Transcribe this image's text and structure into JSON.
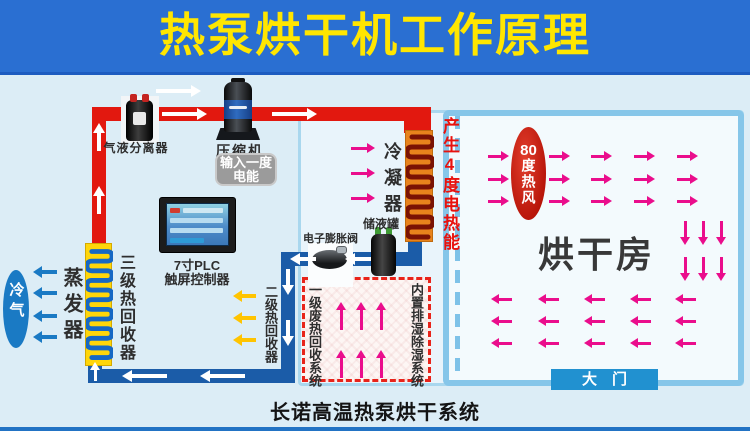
{
  "title": "热泵烘干机工作原理",
  "caption": "长诺高温热泵烘干系统",
  "labels": {
    "separator": "气液分离器",
    "compressor": "压缩机",
    "power_input": "输入一度电能",
    "plc_line1": "7寸PLC",
    "plc_line2": "触屏控制器",
    "condenser": "冷凝器",
    "heat_gain": "产生4度电热能",
    "receiver": "储液罐",
    "expansion_valve": "电子膨胀阀",
    "evaporator": "蒸发器",
    "cold_air": "冷气",
    "stage3_recovery": "三级热回收器",
    "stage2_recovery": "二级热回收器",
    "stage1_waste_recovery": "一级废热回收系统",
    "dehumidify_system": "内置排湿除湿系统",
    "hot_wind_num": "80",
    "hot_wind_text": "度热风",
    "drying_room": "烘干房",
    "door": "大　门"
  },
  "colors": {
    "title_bg": "#2a6fd2",
    "title_text": "#ffe600",
    "hot_pipe": "#e2180f",
    "liquid_pipe": "#1b5ca8",
    "condenser_body": "#e8831c",
    "evaporator_body": "#ffd60a",
    "heat_arrow": "#ea0d8c",
    "cold_arrow": "#1a7ac4",
    "stage2_arrow": "#ffc400",
    "hot_wind_oval": "#c01a0c",
    "door_bg": "#2191d0",
    "room_border": "#86c6e9",
    "waste_box_border": "#e8231a"
  },
  "flows": [
    {
      "name": "hot-gas-arrow",
      "dir": "right",
      "color": "#ffffff",
      "len": 45,
      "w": 4,
      "hw": 6,
      "hl": 10,
      "points": [
        [
          156,
          91
        ],
        [
          162,
          114
        ],
        [
          272,
          114
        ]
      ]
    },
    {
      "name": "hot-gas-up-arrow",
      "dir": "up",
      "color": "#ffffff",
      "len": 28,
      "w": 4,
      "hw": 6,
      "hl": 10,
      "points": [
        [
          99,
          123
        ],
        [
          99,
          186
        ]
      ]
    },
    {
      "name": "liquid-left-arrow",
      "dir": "left",
      "color": "#ffffff",
      "len": 26,
      "w": 4,
      "hw": 6,
      "hl": 10,
      "points": [
        [
          290,
          259
        ],
        [
          345,
          259
        ]
      ]
    },
    {
      "name": "liquid-down-arrow",
      "dir": "down",
      "color": "#ffffff",
      "len": 26,
      "w": 4,
      "hw": 6,
      "hl": 10,
      "points": [
        [
          288,
          269
        ],
        [
          288,
          320
        ]
      ]
    },
    {
      "name": "return-left-arrow",
      "dir": "left",
      "color": "#ffffff",
      "len": 45,
      "w": 4,
      "hw": 6,
      "hl": 10,
      "points": [
        [
          122,
          376
        ],
        [
          200,
          376
        ]
      ]
    },
    {
      "name": "evap-in-up-arrow",
      "dir": "up",
      "color": "#ffffff",
      "len": 19,
      "w": 3,
      "hw": 5,
      "hl": 8,
      "points": [
        [
          95,
          362
        ]
      ]
    },
    {
      "name": "condenser-heat-arrow",
      "dir": "right",
      "color": "#ea0d8c",
      "len": 24,
      "w": 3,
      "hw": 5,
      "hl": 8,
      "points": [
        [
          351,
          148
        ],
        [
          351,
          173
        ],
        [
          351,
          198
        ]
      ]
    },
    {
      "name": "waste-heat-up-arrow",
      "dir": "up",
      "color": "#ea0d8c",
      "len": 28,
      "w": 3,
      "hw": 5,
      "hl": 8,
      "points": [
        [
          341,
          302
        ],
        [
          361,
          302
        ],
        [
          381,
          302
        ],
        [
          341,
          350
        ],
        [
          361,
          350
        ],
        [
          381,
          350
        ]
      ]
    },
    {
      "name": "hot-wind-right-arrow",
      "dir": "right",
      "color": "#ea0d8c",
      "len": 21,
      "w": 3,
      "hw": 5,
      "hl": 8,
      "points": [
        [
          488,
          156
        ],
        [
          488,
          179
        ],
        [
          488,
          201
        ],
        [
          549,
          156
        ],
        [
          549,
          179
        ],
        [
          549,
          201
        ],
        [
          591,
          156
        ],
        [
          591,
          179
        ],
        [
          591,
          201
        ],
        [
          634,
          156
        ],
        [
          634,
          179
        ],
        [
          634,
          201
        ],
        [
          677,
          156
        ],
        [
          677,
          179
        ],
        [
          677,
          201
        ]
      ]
    },
    {
      "name": "hot-wind-down-arrow",
      "dir": "down",
      "color": "#ea0d8c",
      "len": 24,
      "w": 3,
      "hw": 5,
      "hl": 8,
      "points": [
        [
          685,
          221
        ],
        [
          703,
          221
        ],
        [
          721,
          221
        ],
        [
          685,
          257
        ],
        [
          703,
          257
        ],
        [
          721,
          257
        ]
      ]
    },
    {
      "name": "hot-wind-left-arrow",
      "dir": "left",
      "color": "#ea0d8c",
      "len": 21,
      "w": 3,
      "hw": 5,
      "hl": 8,
      "points": [
        [
          491,
          299
        ],
        [
          491,
          321
        ],
        [
          491,
          343
        ],
        [
          538,
          299
        ],
        [
          538,
          321
        ],
        [
          538,
          343
        ],
        [
          584,
          299
        ],
        [
          584,
          321
        ],
        [
          584,
          343
        ],
        [
          630,
          299
        ],
        [
          630,
          321
        ],
        [
          630,
          343
        ],
        [
          675,
          299
        ],
        [
          675,
          321
        ],
        [
          675,
          343
        ]
      ]
    },
    {
      "name": "stage2-recovery-arrow",
      "dir": "left",
      "color": "#ffc400",
      "len": 23,
      "w": 4,
      "hw": 6,
      "hl": 9,
      "points": [
        [
          233,
          296
        ],
        [
          233,
          318
        ],
        [
          233,
          340
        ]
      ]
    },
    {
      "name": "cold-air-arrow",
      "dir": "left",
      "color": "#1a7ac4",
      "len": 24,
      "w": 4,
      "hw": 6,
      "hl": 9,
      "points": [
        [
          33,
          272
        ],
        [
          33,
          293
        ],
        [
          33,
          316
        ],
        [
          33,
          337
        ]
      ]
    }
  ]
}
